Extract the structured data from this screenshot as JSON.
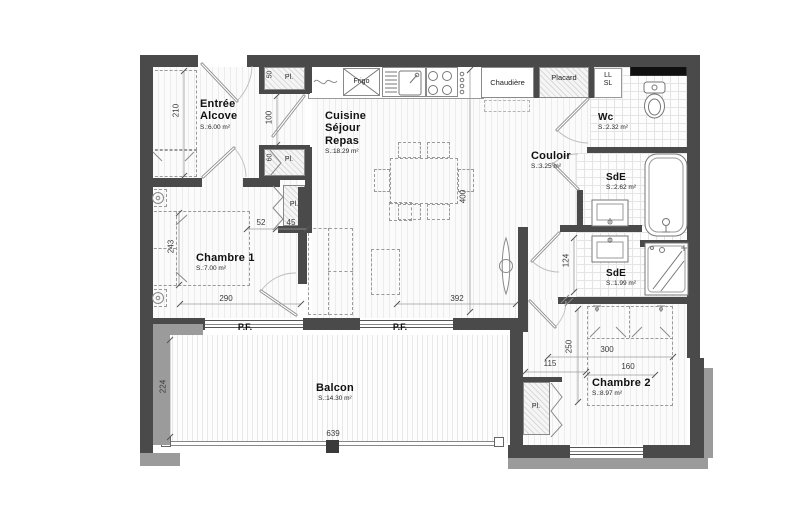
{
  "rooms": {
    "entree": {
      "line1": "Entrée",
      "line2": "Alcove",
      "area": "S.:6.00 m²"
    },
    "cuisine": {
      "line1": "Cuisine",
      "line2": "Séjour",
      "line3": "Repas",
      "area": "S.:18.29 m²"
    },
    "chambre1": {
      "name": "Chambre 1",
      "area": "S.:7.00 m²"
    },
    "wc": {
      "name": "Wc",
      "area": "S.:2.32 m²"
    },
    "couloir": {
      "name": "Couloir",
      "area": "S.:3.25 m²"
    },
    "sde1": {
      "name": "SdE",
      "area": "S.:2.62 m²"
    },
    "sde2": {
      "name": "SdE",
      "area": "S.:1.99 m²"
    },
    "chambre2": {
      "name": "Chambre 2",
      "area": "S.:8.97 m²"
    },
    "balcon": {
      "name": "Balcon",
      "area": "S.:14.30 m²"
    }
  },
  "labels": {
    "pl": "Pl.",
    "pf": "P.F.",
    "frigo": "Frigo",
    "chaudiere": "Chaudière",
    "placard": "Placard",
    "ll": "LL",
    "sl": "SL"
  },
  "dimensions": {
    "d210": "210",
    "d100": "100",
    "d50": "50",
    "d60": "60",
    "d52": "52",
    "d45": "45",
    "d243": "243",
    "d290": "290",
    "d400": "400",
    "d392": "392",
    "d124": "124",
    "d250": "250",
    "d115": "115",
    "d300": "300",
    "d160": "160",
    "d224": "224",
    "d639": "639"
  },
  "colors": {
    "wall": "#4a4a4a",
    "wall_light": "#9b9b9b",
    "window_dark": "#101010"
  }
}
